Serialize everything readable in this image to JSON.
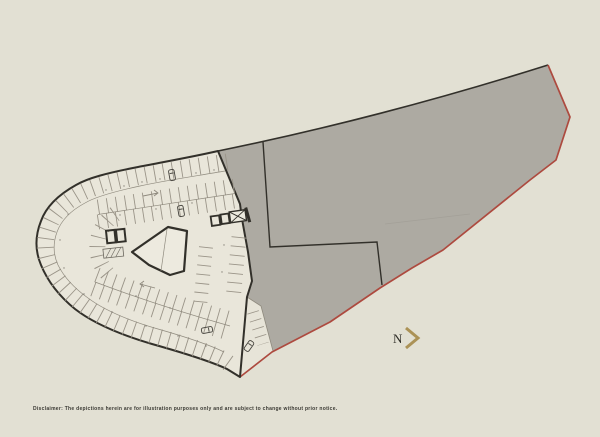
{
  "map": {
    "type": "site-plan",
    "parcel": "gray land parcel with red lot boundary",
    "building": "curved parking garage floor plan"
  },
  "north_indicator": {
    "label": "N",
    "icon": "chevron-right"
  },
  "footer": {
    "disclaimer": "Disclaimer: The depictions herein are for illustration purposes only and are subject to change without prior notice."
  },
  "colors": {
    "background": "#e2e0d3",
    "parcel-gray": "#adaaa2",
    "plan-fill": "#e9e6da",
    "outline-dark": "#32302a",
    "boundary-red": "#ad4a3f",
    "gold": "#ab9256",
    "line-light": "#9a9488",
    "text-dark": "#3a3933"
  }
}
